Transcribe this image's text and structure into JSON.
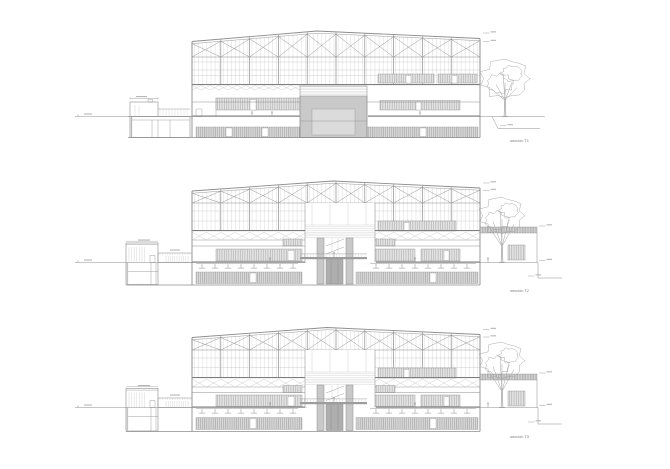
{
  "document": {
    "type": "architectural-section-sheet",
    "background": "#ffffff"
  },
  "palette": {
    "line": "#8c8c8c",
    "light": "#c3c3c3",
    "dark": "#6f6f6f",
    "slab": "#7d7d7d",
    "hatch_bg": "#e4e4e4",
    "hatch_line": "#ababab",
    "basement_bg": "#dadada",
    "basement_line": "#9d9d9d",
    "walkway_bg": "#dcdcdc",
    "walkway_line": "#909090",
    "panel": "#c9c9c9",
    "panel_light": "#dbdbdb",
    "core_dark": "#aeaeae",
    "bridge": "#9c9c9c",
    "tree": "#a2a2a2",
    "micro": "#b6b6b6",
    "label": "#6f6f6f"
  },
  "sections": [
    {
      "id": "T1",
      "label": "sección T1"
    },
    {
      "id": "T2",
      "label": "sección T2"
    },
    {
      "id": "T3",
      "label": "sección T3"
    }
  ]
}
